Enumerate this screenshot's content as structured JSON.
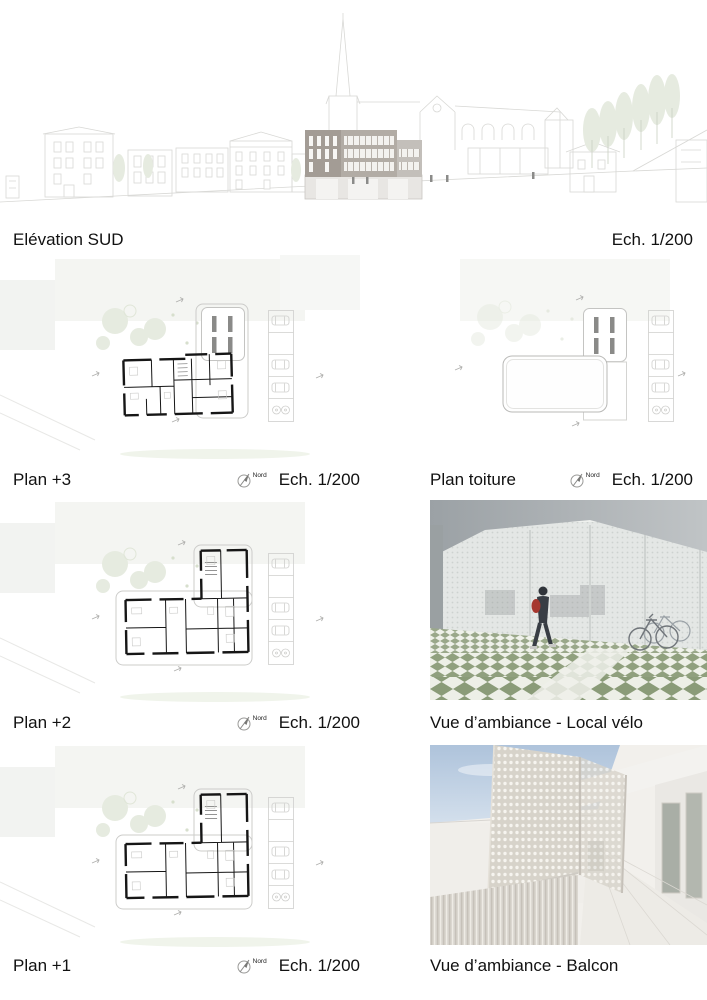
{
  "captions": {
    "elevation": {
      "title": "Elévation SUD",
      "scale": "Ech. 1/200"
    },
    "plan3": {
      "title": "Plan +3",
      "scale": "Ech. 1/200"
    },
    "toiture": {
      "title": "Plan toiture",
      "scale": "Ech. 1/200"
    },
    "plan2": {
      "title": "Plan +2",
      "scale": "Ech. 1/200"
    },
    "velo": {
      "title": "Vue d’ambiance - Local vélo"
    },
    "plan1": {
      "title": "Plan +1",
      "scale": "Ech. 1/200"
    },
    "balcon": {
      "title": "Vue d’ambiance - Balcon"
    }
  },
  "compass": {
    "label": "Nord"
  },
  "colors": {
    "linework": "#d8d8d5",
    "facade": "#b2aca5",
    "facade-dark": "#a39c95",
    "facade-light": "#c3bfba",
    "tree": "#e6ebe0",
    "floor-green": "#94a483",
    "sky": "#b5c8de",
    "backpack": "#a6372e",
    "plan-wall": "#161616",
    "plan-light": "#ccccca",
    "text": "#111111"
  }
}
